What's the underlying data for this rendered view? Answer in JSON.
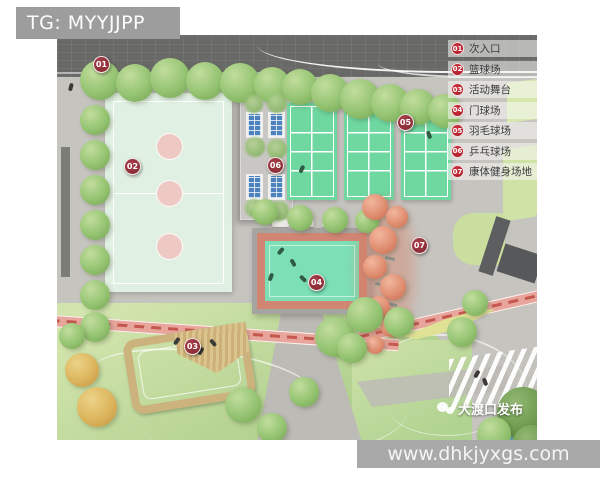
{
  "header": {
    "tg_watermark": "TG: MYYJJPP"
  },
  "legend": {
    "items": [
      {
        "num": "01",
        "label": "次入口"
      },
      {
        "num": "02",
        "label": "篮球场"
      },
      {
        "num": "03",
        "label": "活动舞台"
      },
      {
        "num": "04",
        "label": "门球场"
      },
      {
        "num": "05",
        "label": "羽毛球场"
      },
      {
        "num": "06",
        "label": "乒乓球场"
      },
      {
        "num": "07",
        "label": "康体健身场地"
      }
    ]
  },
  "markers": [
    {
      "num": "01"
    },
    {
      "num": "02"
    },
    {
      "num": "03"
    },
    {
      "num": "04"
    },
    {
      "num": "05"
    },
    {
      "num": "06"
    },
    {
      "num": "07"
    }
  ],
  "footer": {
    "website": "www.dhkjyxgs.com",
    "publisher": "大渡口发布"
  },
  "colors": {
    "legend_badge_red": "#b01f2a",
    "marker_red": "#8c2d36",
    "badminton_green": "#6fd7a0",
    "gateball_mint": "#7cdfb6",
    "gateball_band": "#d08673",
    "basketball_court": "#e0f0e2",
    "lawn_green": "#b7d494",
    "track_pink": "#e7a59c",
    "salmon_tree": "#e08e71",
    "road_gray": "#696967",
    "panel_blue": "#4d82bd"
  }
}
